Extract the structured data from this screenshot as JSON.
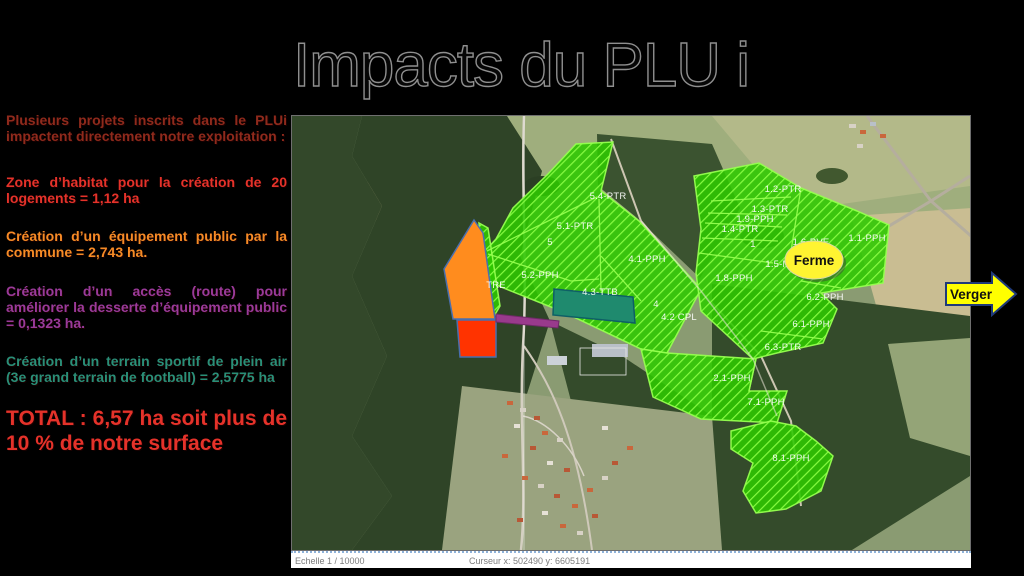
{
  "title": "Impacts du PLU i",
  "sidebar": {
    "intro": {
      "text": "Plusieurs projets inscrits dans le PLUi impactent directement notre exploitation :",
      "color": "#8f2a1c"
    },
    "items": [
      {
        "text": "Zone d’habitat  pour la création de 20 logements = 1,12 ha",
        "color": "#e5322a"
      },
      {
        "text": "Création d’un équipement public par la commune = 2,743 ha.",
        "color": "#f68b26"
      },
      {
        "text": "Création d’un accès (route) pour améliorer la desserte d’équipement public = 0,1323 ha.",
        "color": "#9a3a9a"
      },
      {
        "text": "Création d’un terrain sportif de plein air (3e grand terrain de football) = 2,5775 ha",
        "color": "#2a8f78"
      }
    ],
    "total": {
      "text": "TOTAL : 6,57 ha soit plus de 10 % de notre surface",
      "color": "#e5322a"
    }
  },
  "map": {
    "ferme_label": "Ferme",
    "verger_label": "Verger",
    "statusbar": {
      "scale": "Echelle 1 / 10000",
      "cursor": "Curseur x: 502490 y: 6605191"
    },
    "colors": {
      "parcel_green": "#2ec800",
      "parcel_hatch": "#8cff46",
      "overlay_orange": "#ff8c1e",
      "overlay_red": "#ff3300",
      "overlay_purple": "#993a8c",
      "overlay_teal": "#1f8a6e",
      "ferme_fill": "#fff431",
      "verger_fill": "#ffff00"
    },
    "parcel_labels": [
      {
        "text": "5.4-PTR",
        "x": 316,
        "y": 83
      },
      {
        "text": "5.1-PTR",
        "x": 283,
        "y": 113
      },
      {
        "text": "5",
        "x": 258,
        "y": 129
      },
      {
        "text": "5.2-PPH",
        "x": 248,
        "y": 162
      },
      {
        "text": "TRE",
        "x": 204,
        "y": 172
      },
      {
        "text": "4.1-PPH",
        "x": 355,
        "y": 146
      },
      {
        "text": "4.3-TTB",
        "x": 308,
        "y": 179
      },
      {
        "text": "4",
        "x": 364,
        "y": 191
      },
      {
        "text": "4.2 CPL",
        "x": 387,
        "y": 204
      },
      {
        "text": "1.2-PTR",
        "x": 491,
        "y": 76
      },
      {
        "text": "1.3-PTR",
        "x": 478,
        "y": 96
      },
      {
        "text": "1.9-PPH",
        "x": 463,
        "y": 106
      },
      {
        "text": "1.4-PTR",
        "x": 448,
        "y": 116
      },
      {
        "text": "1",
        "x": 461,
        "y": 131
      },
      {
        "text": "1.6-PVE",
        "x": 519,
        "y": 129
      },
      {
        "text": "1.1-PPH",
        "x": 575,
        "y": 125
      },
      {
        "text": "1.5-M",
        "x": 486,
        "y": 151
      },
      {
        "text": "1.8-PPH",
        "x": 442,
        "y": 165
      },
      {
        "text": "6.2-PPH",
        "x": 533,
        "y": 184
      },
      {
        "text": "6.1-PPH",
        "x": 519,
        "y": 211
      },
      {
        "text": "6.3-PTR",
        "x": 491,
        "y": 234
      },
      {
        "text": "2.1-PPH",
        "x": 440,
        "y": 265
      },
      {
        "text": "7.1-PPH",
        "x": 474,
        "y": 289
      },
      {
        "text": "8.1-PPH",
        "x": 499,
        "y": 345
      }
    ]
  }
}
